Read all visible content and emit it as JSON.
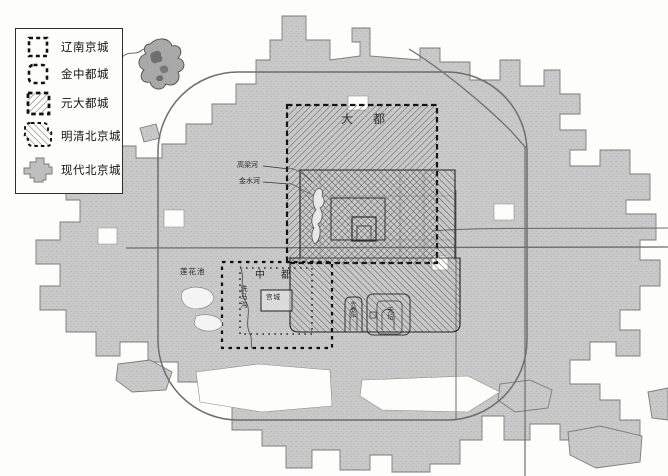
{
  "legend": {
    "items": [
      {
        "label": "辽南京城",
        "symbol": "dashed-square-outline"
      },
      {
        "label": "金中都城",
        "symbol": "dashed-rounded-square-outline"
      },
      {
        "label": "元大都城",
        "symbol": "diagonal-hatch-square-dashed-border"
      },
      {
        "label": "明清北京城",
        "symbol": "diagonal-hatch-blob-dashed-border"
      },
      {
        "label": "现代北京城",
        "symbol": "solid-gray-blob"
      }
    ]
  },
  "map": {
    "labels": {
      "dadu": "大都",
      "zhongdu": "中都",
      "gongcheng": "宫城",
      "gaoliang_river": "高梁河",
      "jinshui_river": "金水河",
      "lianhua_pond": "莲花池",
      "xima_gou": "洗马沟",
      "xiannongtan": "先农坛",
      "tiantan": "天坛"
    },
    "colors": {
      "modern_city_fill": "#c9c9c9",
      "modern_city_stroke": "#7c7c7c",
      "road": "#6e6e6e",
      "hatch": "#474747",
      "ink": "#1c1c1c",
      "paper": "#fdfdfc"
    }
  }
}
